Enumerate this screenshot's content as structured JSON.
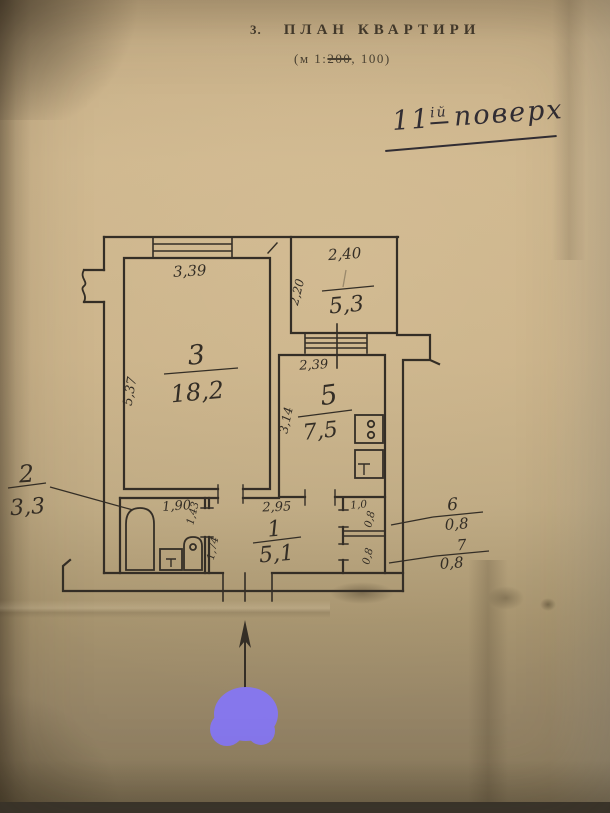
{
  "document": {
    "item_number": "3.",
    "title": "ПЛАН КВАРТИРИ",
    "scale": {
      "prefix": "(м 1:",
      "struck": "200",
      "suffix": ", 100)"
    },
    "floor_note": {
      "number": "11",
      "suffix": "ій",
      "word": "поверх"
    }
  },
  "plan": {
    "rooms": {
      "living": {
        "number": "3",
        "area": "18,2",
        "width": "3,39",
        "height": "5,37"
      },
      "loggia": {
        "area": "5,3",
        "width": "2,40",
        "height": "2,20"
      },
      "kitchen": {
        "number": "5",
        "area": "7,5",
        "width": "2,39",
        "height": "3,14"
      },
      "bathroom": {
        "number": "2",
        "area": "3,3",
        "width": "1,90",
        "height": "1,43"
      },
      "hallway": {
        "number": "1",
        "area": "5,1",
        "width": "2,95",
        "height": "1,74"
      },
      "closet_top": {
        "number": "6",
        "area": "0,8",
        "width": "1,0",
        "depth": "0,8"
      },
      "closet_bottom": {
        "number": "7",
        "area": "0,8",
        "depth": "0,8"
      }
    },
    "colors": {
      "ink": "#342e26",
      "redaction": "#8677ec"
    }
  }
}
